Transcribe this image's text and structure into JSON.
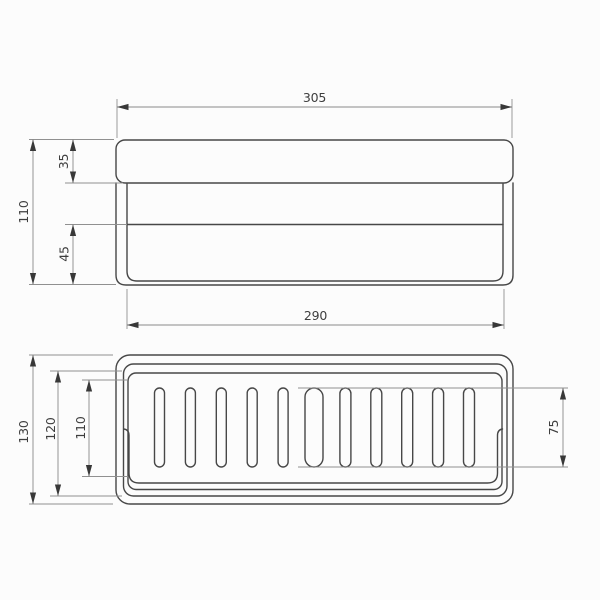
{
  "drawing": {
    "type": "technical-dimension-drawing",
    "subject": "wall-mounted rectangular shower basket, front elevation and top plan view",
    "views": {
      "front": {
        "dimensions": {
          "overall_width": "305",
          "overall_height": "110",
          "rail_height": "35",
          "lower_section_height": "45",
          "inner_width": "290"
        }
      },
      "top": {
        "dimensions": {
          "overall_depth": "130",
          "outer_basket_depth": "120",
          "inner_basket_depth": "110",
          "slot_length": "75"
        },
        "drain_slot_count": 11
      }
    },
    "colors": {
      "background": "#fcfcfc",
      "object_line": "#474747",
      "dimension_line": "#8a8a8a",
      "text": "#3e3e3e"
    }
  }
}
